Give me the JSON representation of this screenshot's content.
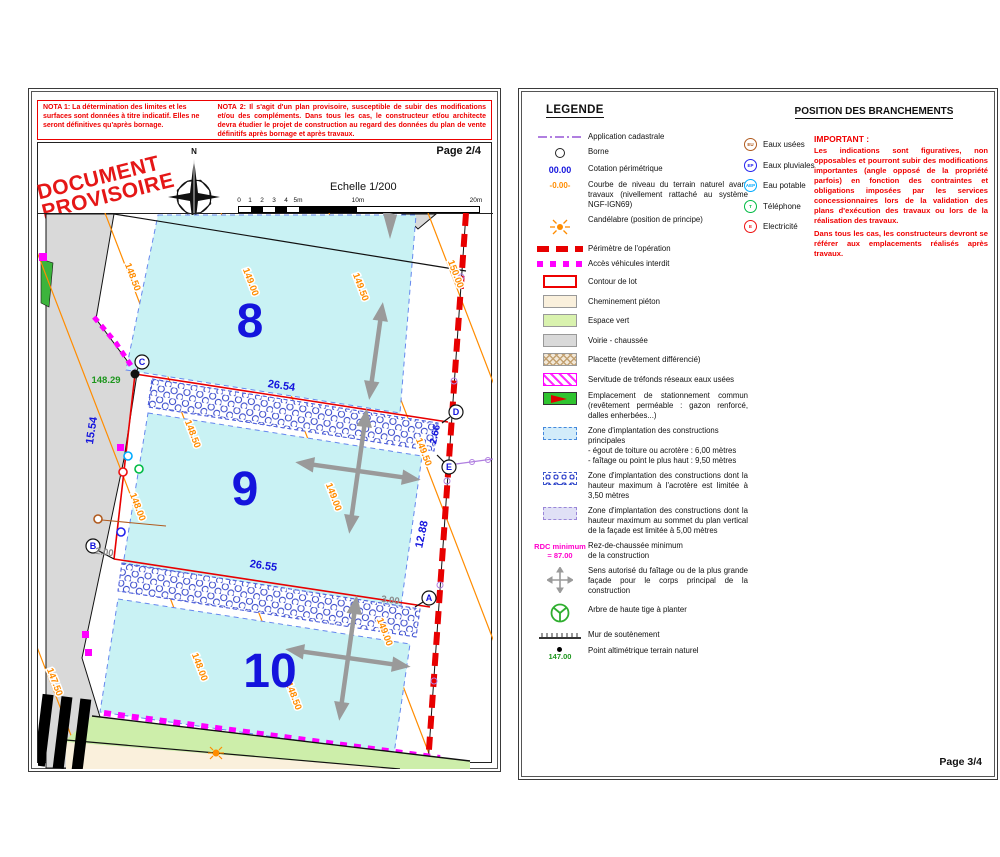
{
  "left_page": {
    "nota1": "NOTA 1: La détermination des limites et les surfaces sont données à titre indicatif. Elles ne  seront définitives qu'après bornage.",
    "nota2": "NOTA 2: Il s'agit d'un plan provisoire, susceptible de subir des modifications et/ou des compléments. Dans tous les cas, le constructeur et/ou architecte devra étudier le projet de construction au regard des données du plan de vente définitifs après bornage et après travaux.",
    "page_label": "Page 2/4",
    "stamp": {
      "line1": "DOCUMENT",
      "line2": "PROVISOIRE"
    },
    "compass_label": "N",
    "scale": {
      "title": "Echelle 1/200",
      "ticks": [
        "0",
        "1",
        "2",
        "3",
        "4",
        "5m",
        "10m",
        "20m"
      ]
    },
    "plan": {
      "lot_numbers": [
        "8",
        "9",
        "10"
      ],
      "dimensions": {
        "lot9_top": "26.54",
        "lot9_bottom": "26.55",
        "lot9_left": "15.54",
        "right_top": "2.66",
        "right_mid": "12.88",
        "offset_left": "2.00",
        "offset_right": "3.00"
      },
      "spot_height_c": "148.29",
      "contour_labels": {
        "c147_50": "147.50",
        "c148_00": "148.00",
        "c148_50": "148.50",
        "c149_00": "149.00",
        "c149_50": "149.50",
        "c150_00": "150.00"
      },
      "points": {
        "a": "A",
        "b": "B",
        "c": "C",
        "d": "D",
        "e": "E"
      }
    }
  },
  "right_page": {
    "legend_title": "LEGENDE",
    "legend": [
      {
        "label": "Application cadastrale"
      },
      {
        "label": "Borne"
      },
      {
        "sym": "00.00",
        "label": "Cotation périmétrique"
      },
      {
        "sym": "-0.00-",
        "label": "Courbe de niveau du terrain naturel avant travaux (nivellement rattaché au système NGF-IGN69)"
      },
      {
        "label": "Candélabre (position de principe)"
      },
      {
        "label": "Périmètre de l'opération"
      },
      {
        "label": "Accès véhicules interdit"
      },
      {
        "label": "Contour de lot"
      },
      {
        "label": "Cheminement piéton"
      },
      {
        "label": "Espace vert"
      },
      {
        "label": "Voirie - chaussée"
      },
      {
        "label": "Placette (revêtement différencié)"
      },
      {
        "label": "Servitude de tréfonds réseaux eaux usées"
      },
      {
        "label": "Emplacement de stationnement commun (revêtement perméable : gazon renforcé, dalles enherbées...)"
      },
      {
        "label": "Zone d'implantation des constructions principales",
        "label2": "- égout de toiture ou acrotère : 6,00 mètres",
        "label3": "- faîtage ou point le plus haut : 9,50 mètres"
      },
      {
        "label": "Zone d'implantation des constructions dont la hauteur maximum à l'acrotère est limitée à 3,50 mètres"
      },
      {
        "label": "Zone d'implantation des constructions dont la hauteur maximum au sommet du  plan vertical de la façade est limitée à 5,00 mètres"
      },
      {
        "sym": "RDC minimum",
        "sym2": "= 87.00",
        "label": "Rez-de-chaussée minimum",
        "label2": "de la construction"
      },
      {
        "label": "Sens autorisé du faîtage ou de la plus grande façade pour le corps principal de la construction"
      },
      {
        "label": "Arbre de haute tige à planter"
      },
      {
        "label": "Mur de soutènement"
      },
      {
        "sym": "147.00",
        "label": "Point altimétrique terrain naturel"
      }
    ],
    "branch_title": "POSITION DES BRANCHEMENTS",
    "branchements": [
      {
        "code": "EU",
        "label": "Eaux usées",
        "color": "#b05a1e"
      },
      {
        "code": "EP",
        "label": "Eaux pluviales",
        "color": "#2222ee"
      },
      {
        "code": "AEP",
        "label": "Eau potable",
        "color": "#00aaff"
      },
      {
        "code": "T",
        "label": "Téléphone",
        "color": "#00bb44"
      },
      {
        "code": "E",
        "label": "Electricité",
        "color": "#ee1111"
      }
    ],
    "important_title": "IMPORTANT :",
    "important_p1": "Les indications sont figuratives, non opposables et pourront subir des modifications importantes (angle opposé de la propriété parfois) en fonction des contraintes et obligations imposées par les services concessionnaires lors de la validation des plans d'exécution des travaux ou lors de la réalisation des travaux.",
    "important_p2": "Dans tous les cas, les constructeurs devront se référer aux emplacements réalisés après travaux.",
    "page_label": "Page 3/4"
  },
  "colors": {
    "nota_red": "#ee0000",
    "dimension_blue": "#1414dd",
    "contour_orange": "#ff8c00",
    "cadastral_violet": "#b07fe0",
    "interdiction_magenta": "#ff00ff",
    "zone_principale_cyan": "#c9f2f4",
    "voirie_gray": "#d9d9d9",
    "espace_vert_green": "#d9f2ae",
    "cheminement_cream": "#faf0dc",
    "spot_height_green": "#1e961e"
  }
}
